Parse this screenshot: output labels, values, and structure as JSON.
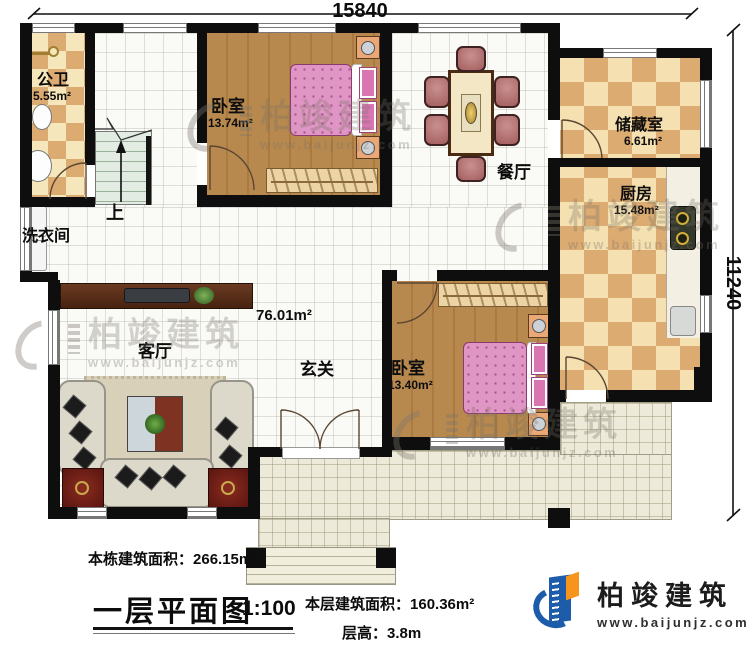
{
  "dimensions": {
    "width": "15840",
    "height": "11240"
  },
  "rooms": {
    "bathroom": {
      "name": "公卫",
      "area": "5.55m²"
    },
    "bedroom_top": {
      "name": "卧室",
      "area": "13.74m²"
    },
    "dining": {
      "name": "餐厅"
    },
    "storage": {
      "name": "储藏室",
      "area": "6.61m²"
    },
    "kitchen": {
      "name": "厨房",
      "area": "15.48m²"
    },
    "laundry": {
      "name": "洗衣间"
    },
    "living": {
      "name": "客厅"
    },
    "foyer": {
      "name": "玄关"
    },
    "bedroom_bottom": {
      "name": "卧室",
      "area": "13.40m²"
    },
    "hall_area": "76.01m²",
    "stairs_up": "上"
  },
  "watermark": {
    "brand": "柏竣建筑",
    "url": "www.baijunjz.com"
  },
  "footer": {
    "building_area_label": "本栋建筑面积：",
    "building_area_value": "266.15m²",
    "plan_title": "一层平面图",
    "plan_scale": "1:100",
    "floor_area_label": "本层建筑面积：",
    "floor_area_value": "160.36m²",
    "floor_height_label": "层高：",
    "floor_height_value": "3.8m"
  },
  "logo": {
    "brand": "柏竣建筑",
    "url": "www.baijunjz.com"
  },
  "colors": {
    "wall": "#0e0e0e",
    "logo_blue": "#1c5cab",
    "logo_orange": "#f7941d"
  }
}
